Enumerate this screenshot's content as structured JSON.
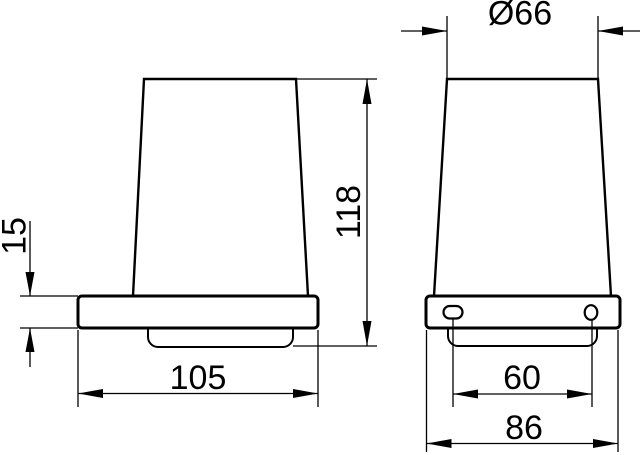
{
  "drawing": {
    "background_color": "#ffffff",
    "line_color": "#000000",
    "views": {
      "side_view": "side view (cup on wall plate)",
      "front_view": "front view (cup on wall plate with mounting holes)"
    },
    "dimensions": {
      "top_diameter": {
        "label": "Ø66"
      },
      "total_height": {
        "label": "118"
      },
      "plate_thickness": {
        "label": "15"
      },
      "plate_depth": {
        "label": "105"
      },
      "hole_spacing": {
        "label": "60"
      },
      "plate_width": {
        "label": "86"
      }
    }
  }
}
